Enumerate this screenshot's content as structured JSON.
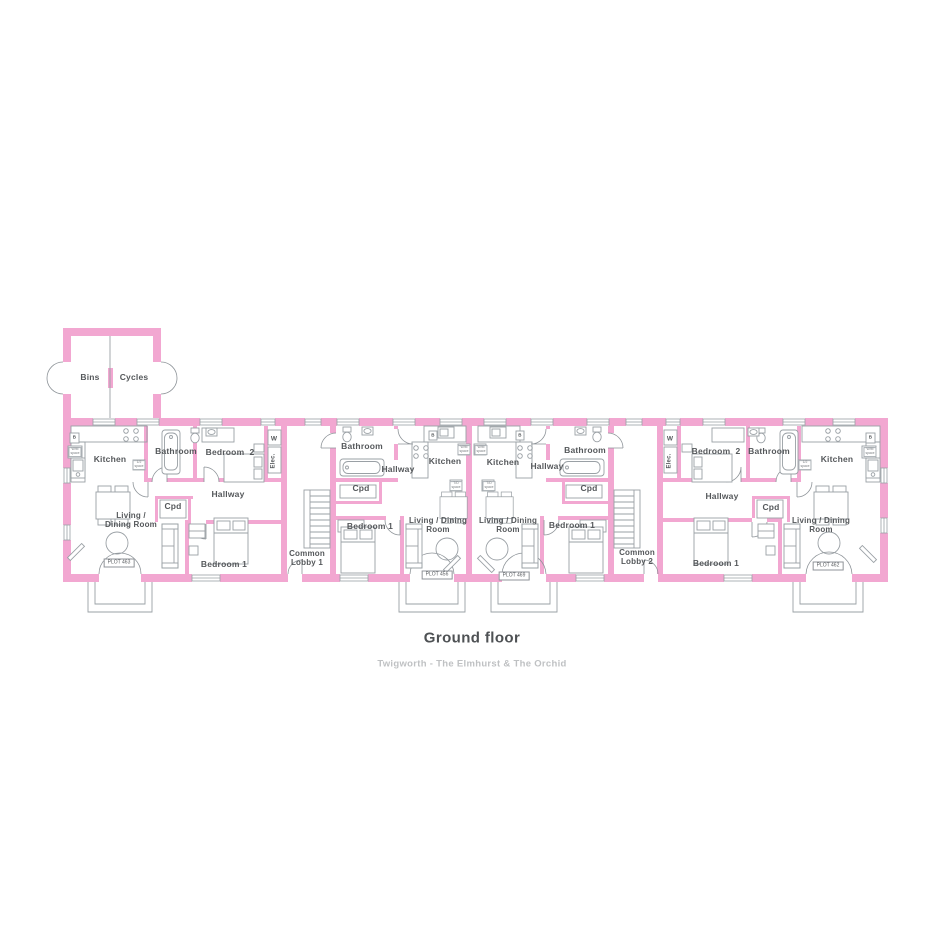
{
  "meta": {
    "floor_title": "Ground floor",
    "development": "Twigworth - The Elmhurst & The Orchid"
  },
  "colors": {
    "wall": "#F2A7D1",
    "line": "#9aa0a5",
    "label": "#55585b",
    "plot_box_border": "#8f9398",
    "title": "#4e5154",
    "subtitle": "#bfc1c3"
  },
  "plots": [
    "PLOT 463",
    "PLOT 456",
    "PLOT 469",
    "PLOT 462"
  ],
  "labels": [
    {
      "name": "room-label-bins",
      "text": "Bins",
      "x": 90,
      "y": 378
    },
    {
      "name": "room-label-cycles",
      "text": "Cycles",
      "x": 134,
      "y": 378
    },
    {
      "name": "room-label-kitchen-463",
      "text": "Kitchen",
      "x": 110,
      "y": 460
    },
    {
      "name": "room-label-bathroom-463",
      "text": "Bathroom",
      "x": 176,
      "y": 452
    },
    {
      "name": "room-label-bedroom2-463",
      "text": "Bedroom  2",
      "x": 230,
      "y": 453
    },
    {
      "name": "room-label-w-463",
      "text": "W",
      "x": 274,
      "y": 439,
      "size": 6.5
    },
    {
      "name": "room-label-elec-463",
      "text": "Elec.",
      "x": 274,
      "y": 461,
      "size": 6,
      "rot": -90
    },
    {
      "name": "room-label-hallway-463",
      "text": "Hallway",
      "x": 228,
      "y": 495
    },
    {
      "name": "room-label-cpd-463",
      "text": "Cpd",
      "x": 173,
      "y": 507
    },
    {
      "name": "room-label-living-463",
      "text": "Living /\nDining Room",
      "x": 131,
      "y": 521,
      "size": 8
    },
    {
      "name": "plot-label-463",
      "text": "PLOT 463",
      "x": 119,
      "y": 563,
      "variant": "plot"
    },
    {
      "name": "room-label-bedroom1-463",
      "text": "Bedroom 1",
      "x": 224,
      "y": 565
    },
    {
      "name": "boiler-label-463",
      "text": "B",
      "x": 74.5,
      "y": 437,
      "size": 4.5
    },
    {
      "name": "appliance-label-wm-463",
      "text": "W/M\nspace",
      "x": 75,
      "y": 452,
      "variant": "tiny"
    },
    {
      "name": "appliance-label-half-463",
      "text": "1/2\nspace",
      "x": 139,
      "y": 465,
      "variant": "tiny"
    },
    {
      "name": "room-label-common-lobby-1",
      "text": "Common\nLobby 1",
      "x": 307,
      "y": 559,
      "size": 8
    },
    {
      "name": "room-label-bathroom-456",
      "text": "Bathroom",
      "x": 362,
      "y": 447
    },
    {
      "name": "room-label-hallway-456",
      "text": "Hallway",
      "x": 398,
      "y": 470
    },
    {
      "name": "room-label-kitchen-456",
      "text": "Kitchen",
      "x": 445,
      "y": 462
    },
    {
      "name": "room-label-cpd-456",
      "text": "Cpd",
      "x": 361,
      "y": 489
    },
    {
      "name": "room-label-bedroom1-456",
      "text": "Bedroom 1",
      "x": 370,
      "y": 527
    },
    {
      "name": "room-label-living-456",
      "text": "Living / Dining\nRoom",
      "x": 438,
      "y": 526,
      "size": 8
    },
    {
      "name": "plot-label-456",
      "text": "PLOT 456",
      "x": 437,
      "y": 575,
      "variant": "plot"
    },
    {
      "name": "boiler-label-456",
      "text": "B",
      "x": 433,
      "y": 435,
      "size": 4.5
    },
    {
      "name": "appliance-label-wm-456",
      "text": "W/M\nspace",
      "x": 464,
      "y": 450,
      "variant": "tiny"
    },
    {
      "name": "appliance-label-td-456",
      "text": "T/D\nspace",
      "x": 456,
      "y": 486,
      "variant": "tiny"
    },
    {
      "name": "room-label-kitchen-469",
      "text": "Kitchen",
      "x": 503,
      "y": 463
    },
    {
      "name": "room-label-hallway-469",
      "text": "Hallway",
      "x": 547,
      "y": 467
    },
    {
      "name": "room-label-bathroom-469",
      "text": "Bathroom",
      "x": 585,
      "y": 451
    },
    {
      "name": "room-label-cpd-469",
      "text": "Cpd",
      "x": 589,
      "y": 489
    },
    {
      "name": "room-label-living-469",
      "text": "Living / Dining\nRoom",
      "x": 508,
      "y": 526,
      "size": 8
    },
    {
      "name": "room-label-bedroom1-469",
      "text": "Bedroom 1",
      "x": 572,
      "y": 526
    },
    {
      "name": "plot-label-469",
      "text": "PLOT 469",
      "x": 514,
      "y": 576,
      "variant": "plot"
    },
    {
      "name": "boiler-label-469",
      "text": "B",
      "x": 520,
      "y": 435,
      "size": 4.5
    },
    {
      "name": "appliance-label-wm-469",
      "text": "W/M\nspace",
      "x": 481,
      "y": 450,
      "variant": "tiny"
    },
    {
      "name": "appliance-label-td-469",
      "text": "T/D\nspace",
      "x": 489,
      "y": 486,
      "variant": "tiny"
    },
    {
      "name": "room-label-common-lobby-2",
      "text": "Common\nLobby 2",
      "x": 637,
      "y": 558,
      "size": 8
    },
    {
      "name": "room-label-w-462",
      "text": "W",
      "x": 670,
      "y": 439,
      "size": 6.5
    },
    {
      "name": "room-label-elec-462",
      "text": "Elec.",
      "x": 670,
      "y": 461,
      "size": 6,
      "rot": -90
    },
    {
      "name": "room-label-bedroom2-462",
      "text": "Bedroom  2",
      "x": 716,
      "y": 452
    },
    {
      "name": "room-label-bathroom-462",
      "text": "Bathroom",
      "x": 769,
      "y": 452
    },
    {
      "name": "room-label-kitchen-462",
      "text": "Kitchen",
      "x": 837,
      "y": 460
    },
    {
      "name": "room-label-hallway-462",
      "text": "Hallway",
      "x": 722,
      "y": 497
    },
    {
      "name": "room-label-cpd-462",
      "text": "Cpd",
      "x": 771,
      "y": 508
    },
    {
      "name": "room-label-bedroom1-462",
      "text": "Bedroom 1",
      "x": 716,
      "y": 564
    },
    {
      "name": "room-label-living-462",
      "text": "Living / Dining\nRoom",
      "x": 821,
      "y": 526,
      "size": 8
    },
    {
      "name": "plot-label-462",
      "text": "PLOT 462",
      "x": 828,
      "y": 566,
      "variant": "plot"
    },
    {
      "name": "boiler-label-462",
      "text": "B",
      "x": 870.5,
      "y": 437,
      "size": 4.5
    },
    {
      "name": "appliance-label-wm-462",
      "text": "W/M\nspace",
      "x": 870,
      "y": 452,
      "variant": "tiny"
    },
    {
      "name": "appliance-label-half-462",
      "text": "1/2\nspace",
      "x": 805,
      "y": 465,
      "variant": "tiny"
    }
  ]
}
